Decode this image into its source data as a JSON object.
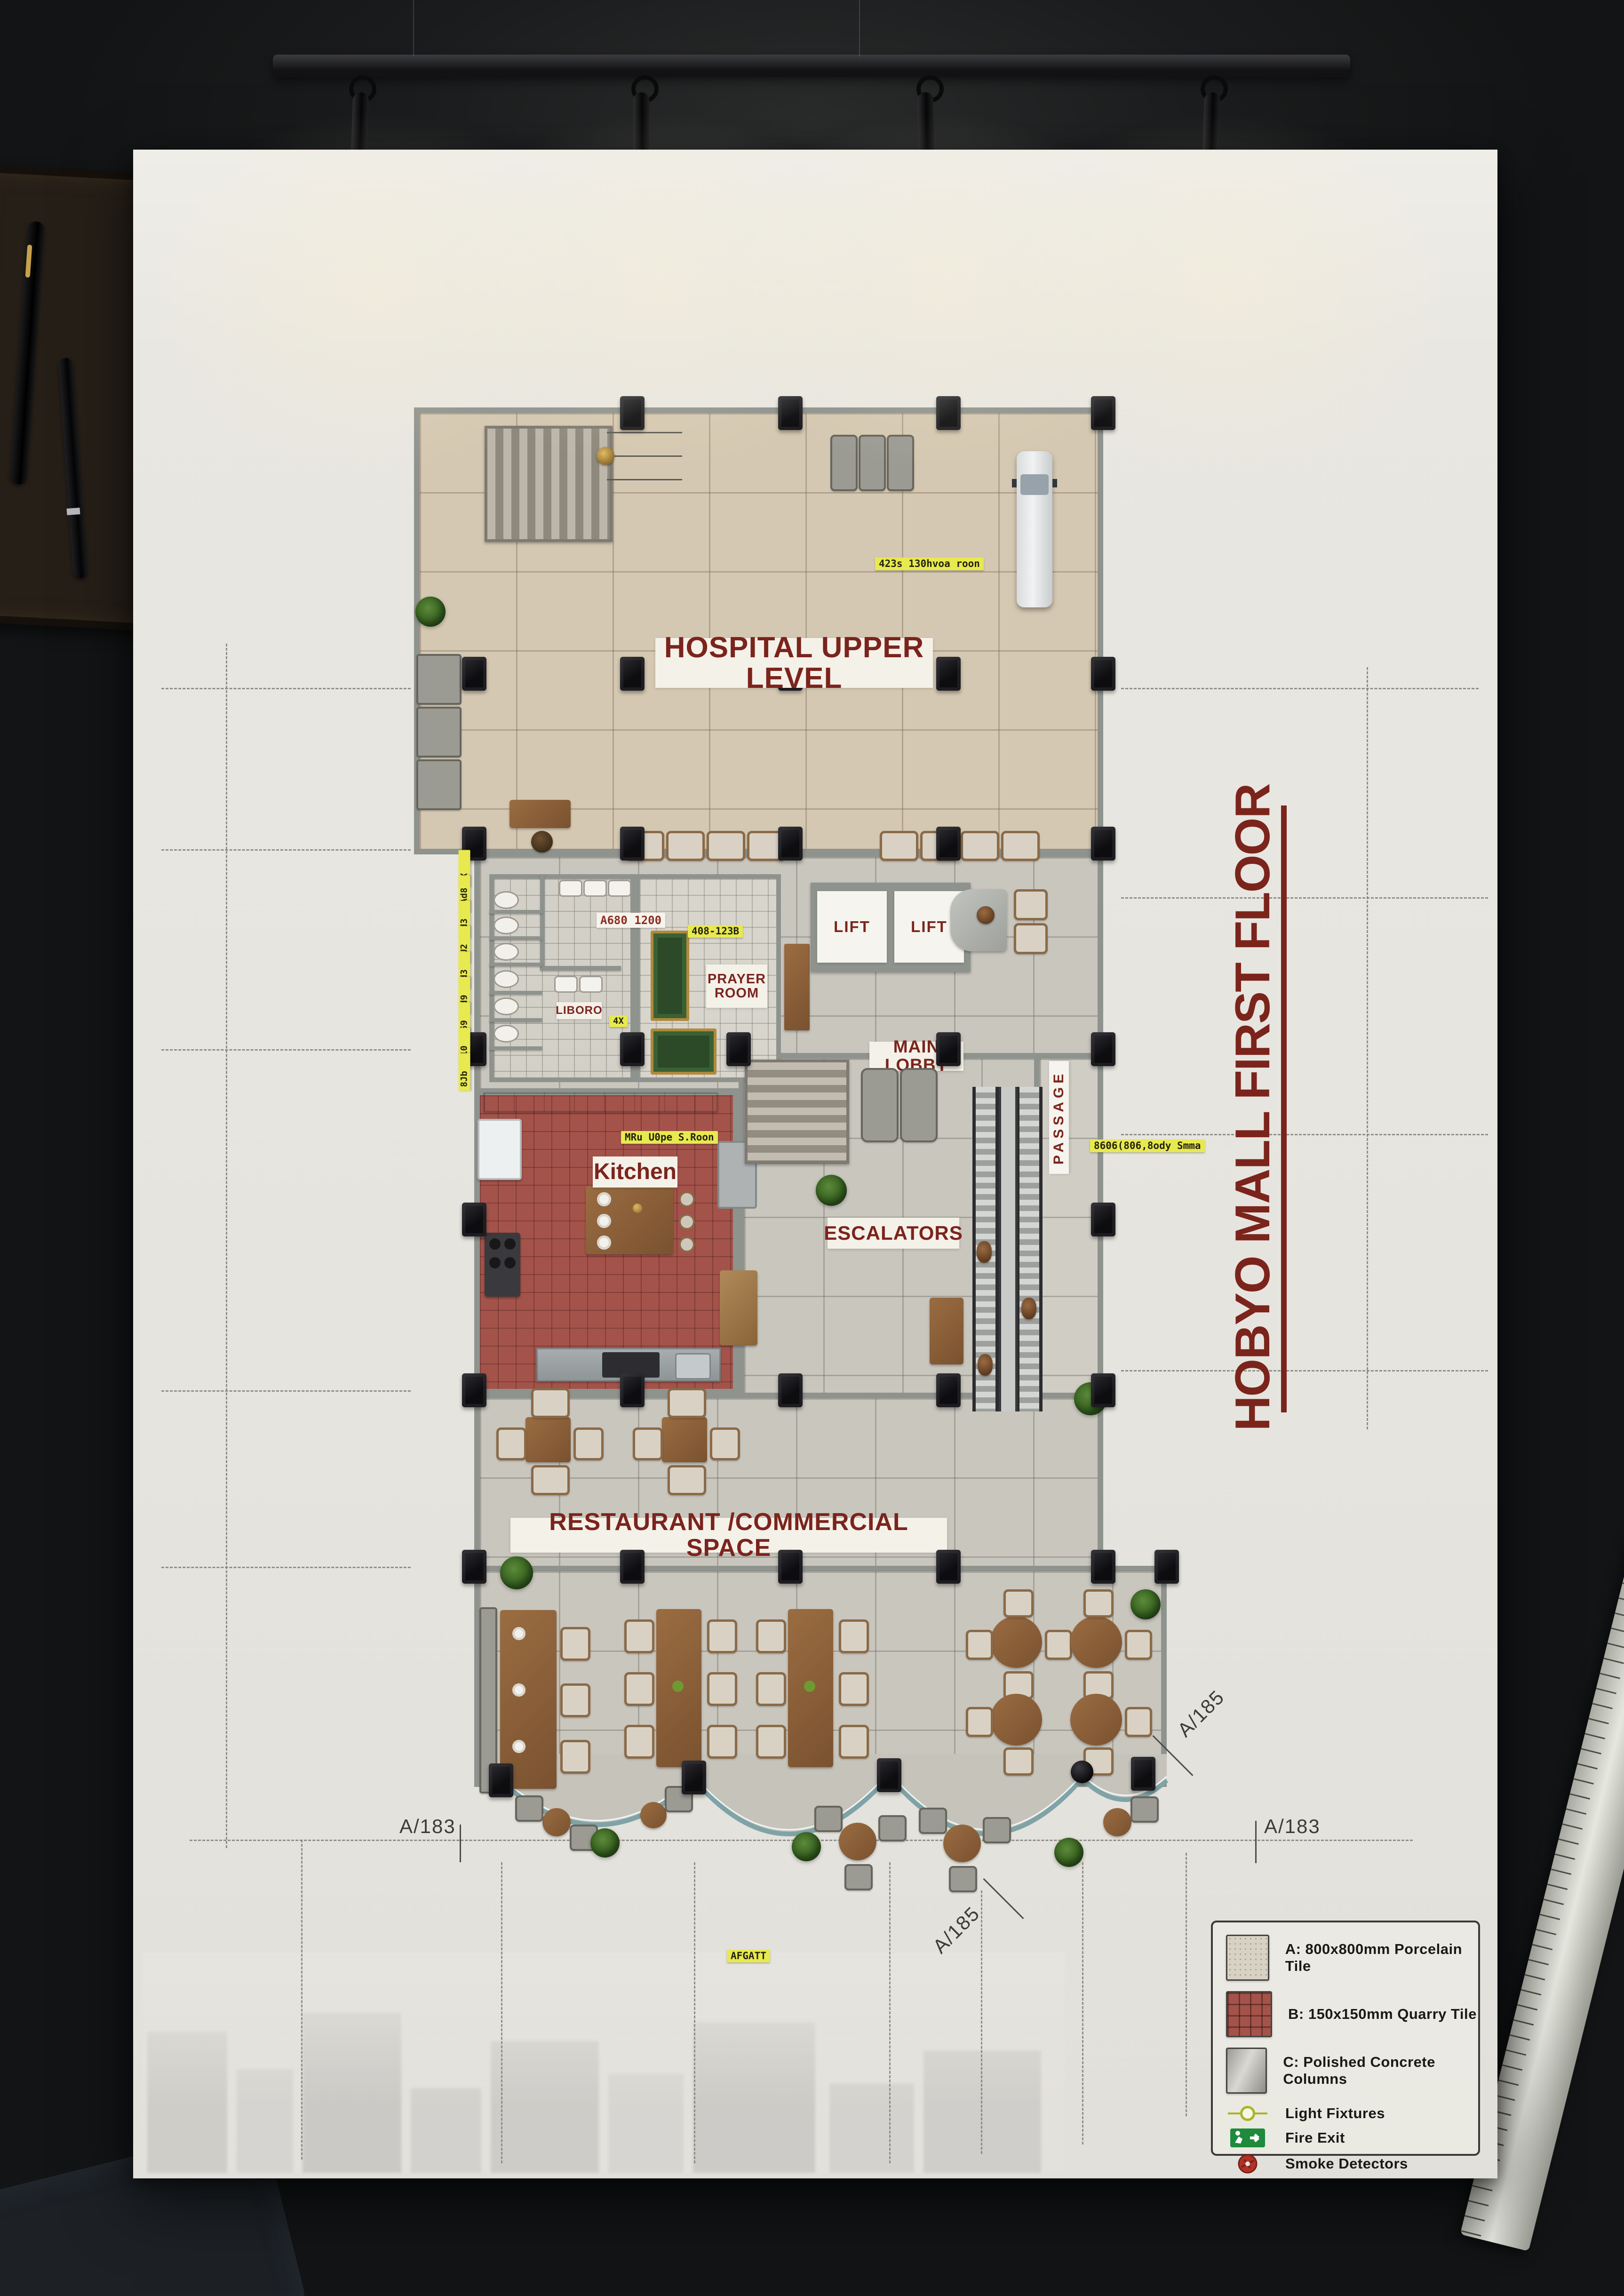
{
  "poster": {
    "title": "HOBYO MALL FIRST FLOOR",
    "rooms": {
      "hospital": "HOSPITAL UPPER LEVEL",
      "prayer_room": "PRAYER ROOM",
      "lift_left": "LIFT",
      "lift_right": "LIFT",
      "main_lobby": "MAIN LOBBY",
      "toilets": "LIBORO",
      "kitchen": "Kitchen",
      "escalators": "ESCALATORS",
      "passage": "PASSAGE",
      "restaurant": "RESTAURANT /COMMERCIAL SPACE"
    },
    "grid_refs": {
      "a183_left": "A/183",
      "a183_right": "A/183",
      "a185_upper": "A/185",
      "a185_lower": "A/185"
    },
    "dims": {
      "hospital_dim": "423s 130hvoa roon",
      "prayer_dim": "408-123B",
      "toilet_dim": "A680 1200",
      "stall_dim": "4X",
      "kitchen_dim": "MRu U0pe S.Roon",
      "passage_dim": "8606(806,8ody Smma",
      "front_dim": "AFGATT",
      "left_stack": [
        "3X",
        "9Ad8",
        "4d3",
        "4U2",
        "1d3",
        "4d9",
        "869",
        "010",
        "8Jb"
      ]
    },
    "legend": {
      "materials": [
        {
          "key": "A",
          "label": "A: 800x800mm Porcelain Tile"
        },
        {
          "key": "B",
          "label": "B: 150x150mm Quarry Tile"
        },
        {
          "key": "C",
          "label": "C: Polished Concrete Columns"
        }
      ],
      "symbols": [
        {
          "label": "Light Fixtures"
        },
        {
          "label": "Fire Exit"
        },
        {
          "label": "Smoke Detectors"
        }
      ]
    },
    "colors": {
      "accent_red": "#7b241c",
      "chip_yellow": "#e7e94f",
      "quarry_red": "#a4534a",
      "porcelain_beige": "#d5c8b2",
      "concrete_gray": "#c9c6be",
      "column_black": "#17171a",
      "fire_exit_green": "#1e8a3c",
      "smoke_detector_red": "#b03227"
    }
  }
}
